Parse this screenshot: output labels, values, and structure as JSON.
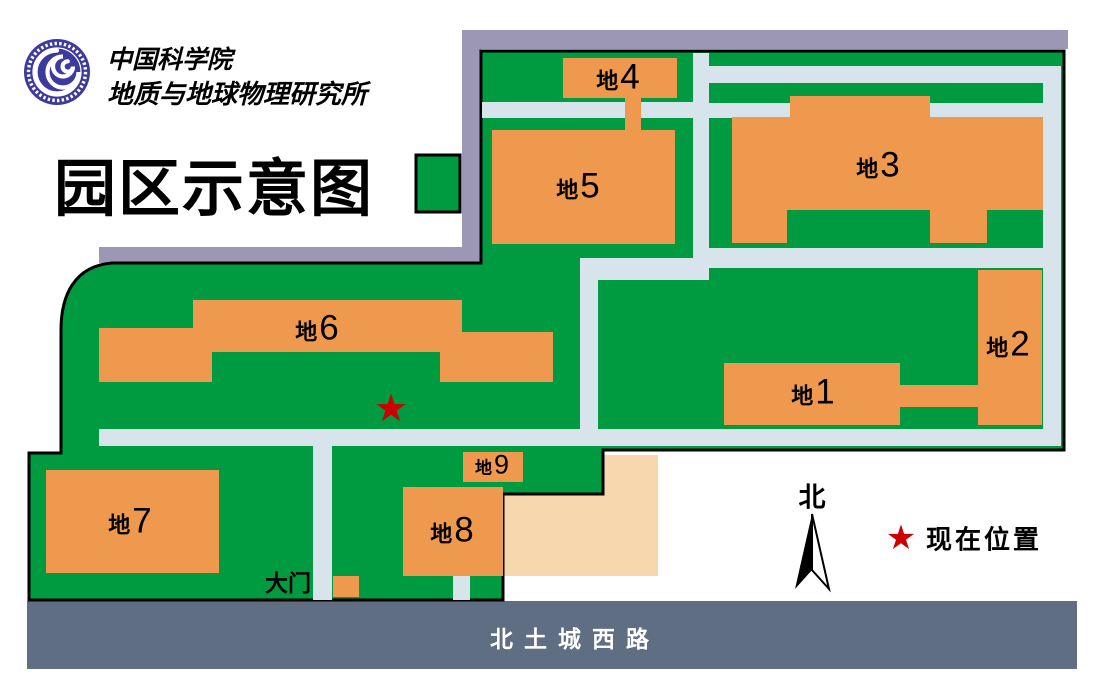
{
  "header": {
    "org_line1": "中国科学院",
    "org_line2": "地质与地球物理研究所",
    "title": "园区示意图"
  },
  "map": {
    "buildings": [
      {
        "prefix": "地",
        "num": "1"
      },
      {
        "prefix": "地",
        "num": "2"
      },
      {
        "prefix": "地",
        "num": "3"
      },
      {
        "prefix": "地",
        "num": "4"
      },
      {
        "prefix": "地",
        "num": "5"
      },
      {
        "prefix": "地",
        "num": "6"
      },
      {
        "prefix": "地",
        "num": "7"
      },
      {
        "prefix": "地",
        "num": "8"
      },
      {
        "prefix": "地",
        "num": "9"
      }
    ],
    "gate_label": "大门",
    "road_label": "北土城西路",
    "current_location_glyph": "★"
  },
  "legend": {
    "north_label": "北",
    "current_location_glyph": "★",
    "current_location_label": "现在位置"
  },
  "colors": {
    "campus_green": "#009A40",
    "building_orange": "#EF994F",
    "annex_peach": "#F6D7AE",
    "path_blue": "#D7E4EC",
    "sidewalk_purple": "#9C97B5",
    "road_gray": "#5F6E82",
    "star_red": "#CC0000",
    "logo_indigo": "#3D3A9E",
    "outline_black": "#000000"
  }
}
